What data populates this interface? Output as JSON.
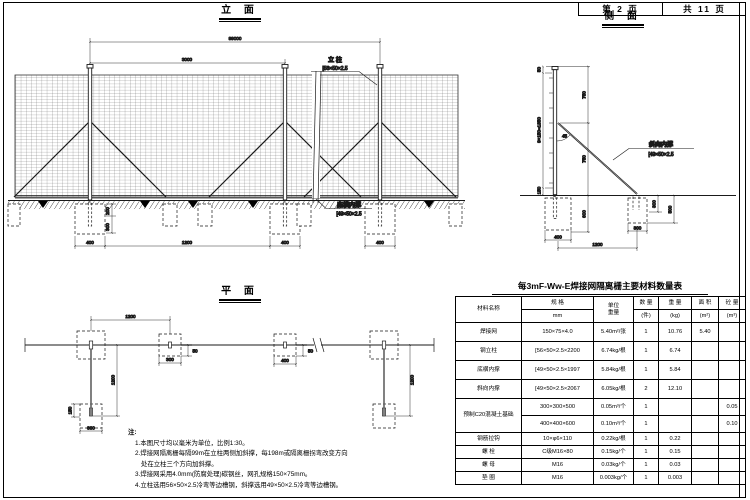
{
  "header": {
    "page_no": "第 2 页",
    "total": "共 11 页"
  },
  "views": {
    "elevation": {
      "title": "立 面",
      "labels": {
        "post_name": "立 柱",
        "post_spec": "[56×50×2.5",
        "rail_name": "底横内撑",
        "rail_spec": "[49×50×2.5"
      },
      "dims": {
        "total": "99000",
        "panel": "3000",
        "found1": "400",
        "span": "1200",
        "found2": "400",
        "found3": "400",
        "depth_a": "200",
        "depth_b": "300"
      }
    },
    "side": {
      "title": "侧 面",
      "labels": {
        "brace_name": "斜向内撑",
        "brace_spec": "[49×50×2.5",
        "angle": "45"
      },
      "dims": {
        "top": "50",
        "mesh": "9×150=1350",
        "gap": "150",
        "upper": "750",
        "lower": "750",
        "embed": "600",
        "found_l": "400",
        "found_r": "300",
        "fr_d1": "300",
        "fr_d2": "500",
        "span": "1200"
      }
    },
    "plan": {
      "title": "平 面",
      "dims": {
        "top_span": "1200",
        "mid_sq": "300",
        "offset_l": "50",
        "vert_l": "1200",
        "stub": "150",
        "bot_sq": "300",
        "right_sq": "400",
        "offset_r": "50",
        "vert_r": "1200"
      }
    }
  },
  "table": {
    "title": "每3mF-Ww-E焊接网隔离栅主要材料数量表",
    "headers": {
      "name": "材料名称",
      "spec": "规  格",
      "spec_unit": "mm",
      "uw1": "单位",
      "uw2": "重量",
      "qty1": "数 量",
      "qty2": "(件)",
      "wt1": "重 量",
      "wt2": "(kg)",
      "area1": "面 积",
      "area2": "(m²)",
      "conc1": "砼 量",
      "conc2": "(m³)"
    },
    "rows": [
      {
        "name": "焊接网",
        "spec": "150×75×4.0",
        "unit": "5.40m²/张",
        "qty": "1",
        "weight": "10.76",
        "area": "5.40",
        "conc": ""
      },
      {
        "name": "钢立柱",
        "spec": "[56×50×2.5×2200",
        "unit": "6.74kg/根",
        "qty": "1",
        "weight": "6.74",
        "area": "",
        "conc": ""
      },
      {
        "name": "底横内撑",
        "spec": "[49×50×2.5×1997",
        "unit": "5.84kg/根",
        "qty": "1",
        "weight": "5.84",
        "area": "",
        "conc": ""
      },
      {
        "name": "斜向内撑",
        "spec": "[49×50×2.5×2067",
        "unit": "6.05kg/根",
        "qty": "2",
        "weight": "12.10",
        "area": "",
        "conc": ""
      },
      {
        "name": "预制C20混凝土基础",
        "spec": "300×300×500",
        "unit": "0.05m³/个",
        "qty": "1",
        "weight": "",
        "area": "",
        "conc": "0.05"
      },
      {
        "spec": "400×400×600",
        "unit": "0.10m³/个",
        "qty": "1",
        "weight": "",
        "area": "",
        "conc": "0.10"
      },
      {
        "name": "钢筋拉钩",
        "spec": "10×φ6×110",
        "unit": "0.22kg/根",
        "qty": "1",
        "weight": "0.22",
        "area": "",
        "conc": ""
      },
      {
        "name": "螺 栓",
        "spec": "C级M16×80",
        "unit": "0.15kg/个",
        "qty": "1",
        "weight": "0.15",
        "area": "",
        "conc": ""
      },
      {
        "name": "螺 母",
        "spec": "M16",
        "unit": "0.03kg/个",
        "qty": "1",
        "weight": "0.03",
        "area": "",
        "conc": ""
      },
      {
        "name": "垫 圈",
        "spec": "M16",
        "unit": "0.003kg/个",
        "qty": "1",
        "weight": "0.003",
        "area": "",
        "conc": ""
      }
    ]
  },
  "notes": {
    "label": "注:",
    "items": [
      "1.本图尺寸均以毫米为单位，比例1:30。",
      "2.焊接网隔离栅每隔99m在立柱两侧加斜撑，每198m或隔离栅拐弯改变方向",
      "处在立柱三个方向加斜撑。",
      "3.焊接网采用4.0mm(防腐处理)碳钢丝，网孔规格150×75mm。",
      "4.立柱选用56×50×2.5冷弯等边槽钢，斜撑选用49×50×2.5冷弯等边槽钢。"
    ]
  }
}
